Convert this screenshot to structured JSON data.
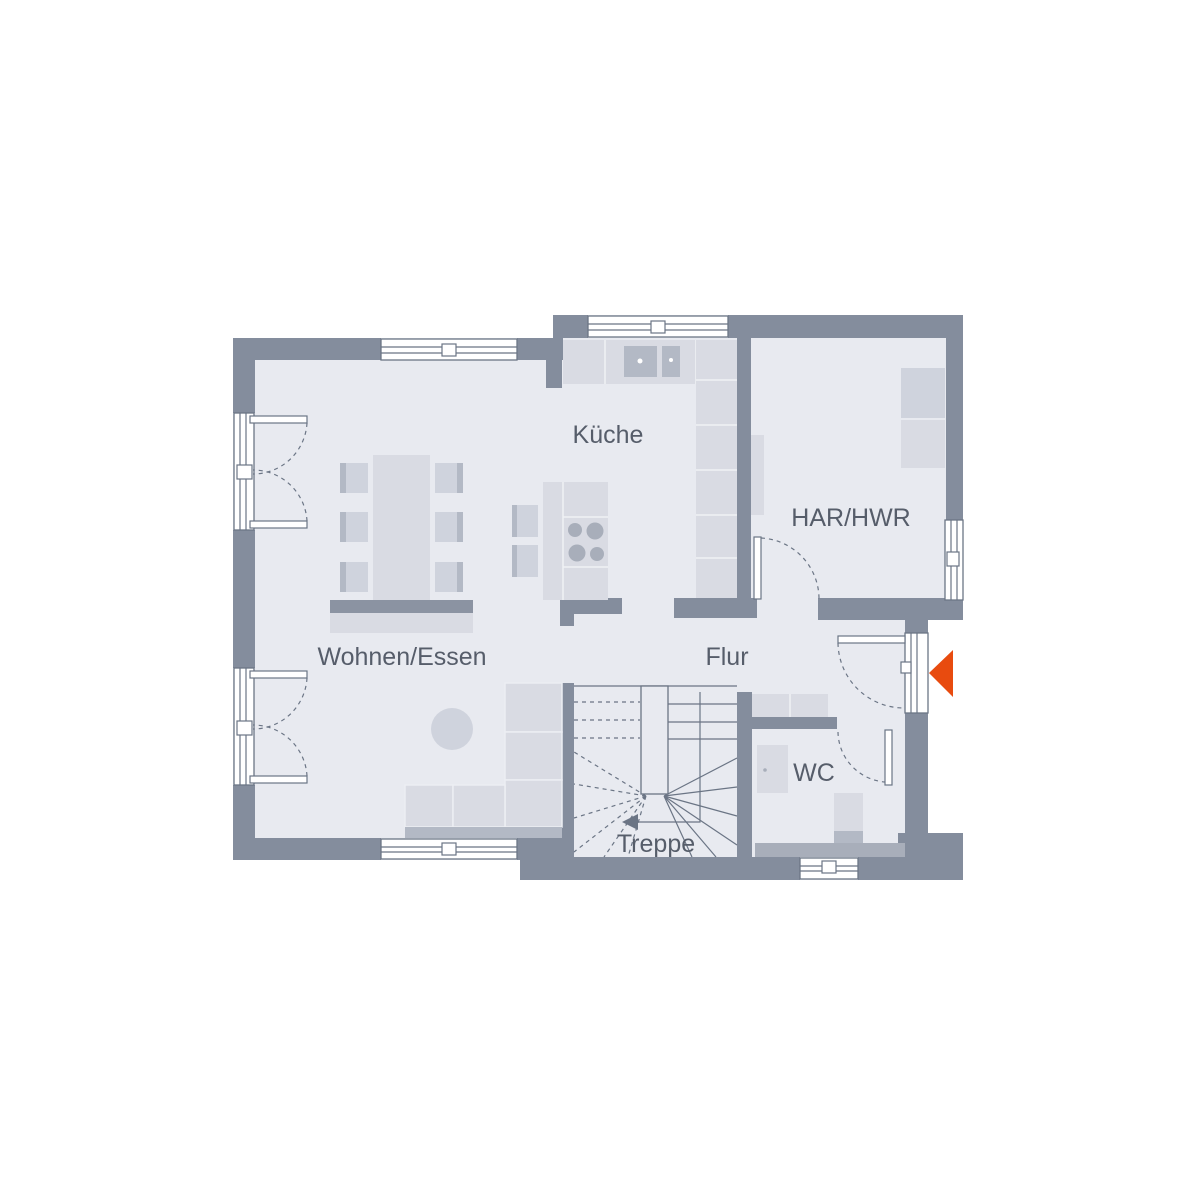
{
  "plan": {
    "type": "floor-plan",
    "level": "ground-floor"
  },
  "rooms": {
    "living": {
      "label": "Wohnen/Essen"
    },
    "kitchen": {
      "label": "Küche"
    },
    "utility": {
      "label": "HAR/HWR"
    },
    "hall": {
      "label": "Flur"
    },
    "wc": {
      "label": "WC"
    },
    "stairs": {
      "label": "Treppe"
    }
  },
  "colors": {
    "background": "#ffffff",
    "wall": "#848d9d",
    "floor": "#e8eaf0",
    "line": "#6b7585",
    "furniture_light": "#d9dbe3",
    "furniture_mid": "#cfd3dd",
    "furniture_dark": "#b3b9c5",
    "furniture_deep": "#a8aeba",
    "accent_dark": "#8b93a2",
    "label_text": "#565d6a",
    "entrance_arrow": "#e84b0f"
  }
}
